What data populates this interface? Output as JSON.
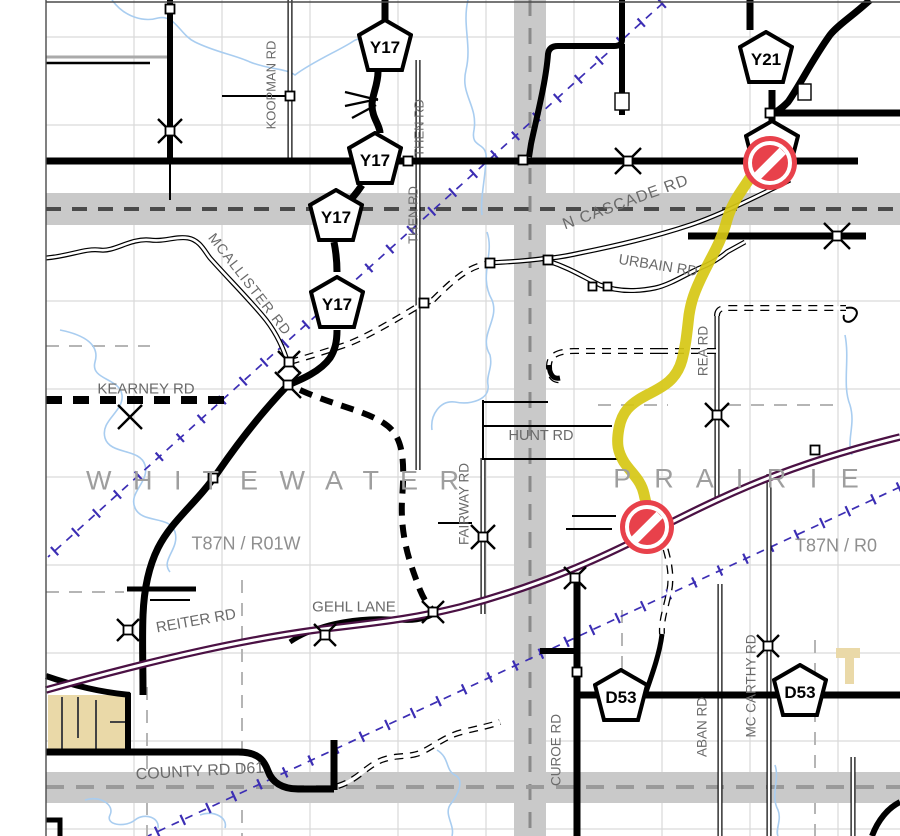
{
  "map": {
    "shields": {
      "y17": "Y17",
      "y21": "Y21",
      "d53": "D53"
    },
    "road_labels": {
      "koopman": "KOOPMAN RD",
      "then": "THEN RD",
      "mcallister": "MCALLISTER RD",
      "kearney": "KEARNEY RD",
      "n_cascade": "N CASCADE RD",
      "urbain": "URBAIN RD",
      "rea": "REA RD",
      "hunt": "HUNT RD",
      "fairway": "FAIRWAY RD",
      "gehl": "GEHL LANE",
      "reiter": "REITER RD",
      "county_d61": "COUNTY RD D61",
      "curoe": "CUROE RD",
      "aban": "ABAN RD",
      "mccarthy": "MC CARTHY RD"
    },
    "townships": {
      "whitewater": "W H I T E W A T E R",
      "prairie": "P R A I R I E",
      "t87n_r01w": "T87N / R01W",
      "t87n_r0": "T87N / R0"
    },
    "closure": {
      "north_icon": "no-entry-icon",
      "south_icon": "no-entry-icon",
      "route_color": "#d6c713",
      "icon_color": "#e8414b"
    },
    "colors": {
      "highway_purple": "#4b1144",
      "trail_blue": "#3c2eb4",
      "stream_blue": "#a9cdf0",
      "corridor_gray": "#c9c9c9",
      "urban_tan": "#ead9a8"
    }
  }
}
